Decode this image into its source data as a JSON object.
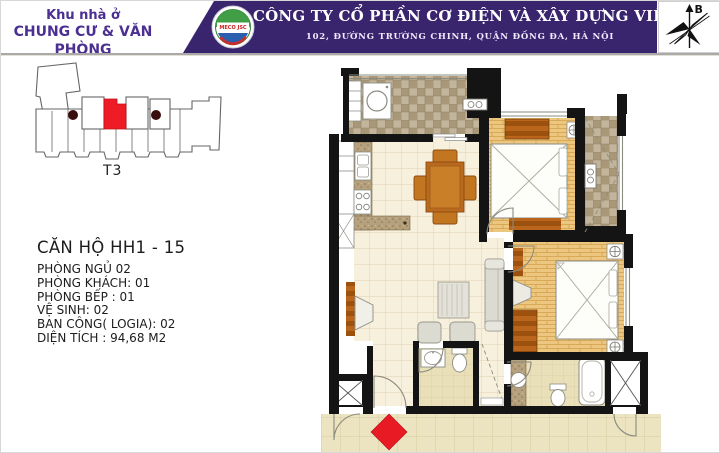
{
  "header": {
    "project": {
      "line1": "Khu nhà ở",
      "line2": "CHUNG CƯ & VĂN PHÒNG"
    },
    "logo_text": "MECO JSC",
    "company_name": "CÔNG TY CỔ PHẦN CƠ ĐIỆN VÀ XÂY DỰNG VIỆT NAM",
    "company_address": "102, ĐƯỜNG TRƯỜNG CHINH, QUẬN ĐỐNG ĐA, HÀ NỘI",
    "compass_label": "B",
    "colors": {
      "banner_bg": "#39246e",
      "project_text": "#4b2f92",
      "banner_text": "#ffffff"
    }
  },
  "key_plan": {
    "tower_label": "T3",
    "highlight_color": "#ee1c25",
    "core_dot_color": "#3a0d0d"
  },
  "apartment_info": {
    "title": "CĂN HỘ  HH1 - 15",
    "lines": [
      "PHÒNG NGỦ 02",
      "PHÒNG KHÁCH: 01",
      "PHÒNG BẾP : 01",
      "VỆ SINH: 02",
      "BAN CÔNG( LOGIA): 02",
      "DIỆN TÍCH : 94,68 M2"
    ]
  },
  "floor_plan": {
    "entry_marker_color": "#e81a24",
    "wall_color": "#141414",
    "floor_colors": {
      "tile": "#f7f0dd",
      "wood": "#edc77f",
      "balcony": "#b3a38b",
      "bath": "#e9dfb9",
      "corridor": "#ece3c0",
      "furniture_wood": "#b9661c",
      "counter_granite": "#b6a17e"
    }
  }
}
